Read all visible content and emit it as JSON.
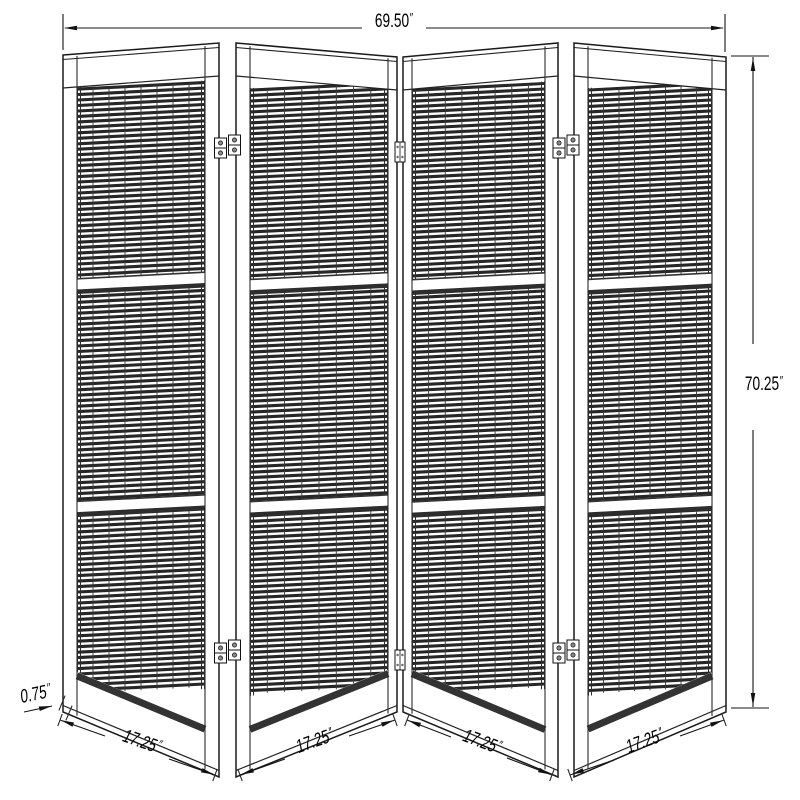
{
  "dimensions": {
    "overall_width": {
      "value": "69.50",
      "unit": "″"
    },
    "overall_height": {
      "value": "70.25",
      "unit": "″"
    },
    "panel_thickness": {
      "value": "0.75",
      "unit": "″"
    },
    "panel_widths": [
      {
        "value": "17.25",
        "unit": "″"
      },
      {
        "value": "17.25",
        "unit": "″"
      },
      {
        "value": "17.25",
        "unit": "″"
      },
      {
        "value": "17.25",
        "unit": "″"
      }
    ]
  },
  "colors": {
    "line": "#1a1a1a",
    "slat": "#262626",
    "background": "#ffffff"
  }
}
